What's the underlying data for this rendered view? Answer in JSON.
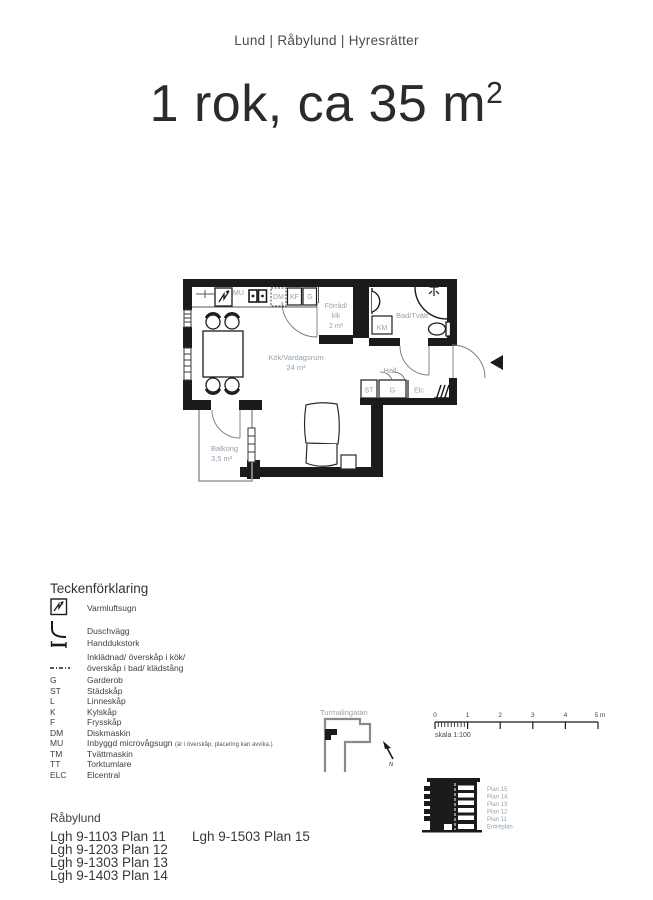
{
  "header": {
    "location_line": "Lund | Råbylund | Hyresrätter"
  },
  "title": {
    "main": "1 rok, ca 35 m",
    "sup": "2"
  },
  "floor_plan": {
    "rooms": {
      "kitchen_living": "Kök/Vardagsrum",
      "kitchen_living_area": "24 m²",
      "storage_line1": "Förråd/",
      "storage_line2": "klk",
      "storage_area": "2 m²",
      "bathroom": "Bad/Tvätt",
      "hall": "Hall",
      "balcony": "Balkong",
      "balcony_area": "3,5 m²"
    },
    "appliances": {
      "mu": "MU",
      "dm": "DM",
      "kf": "KF",
      "g_kitchen": "G",
      "km": "KM",
      "st": "ST",
      "g_hall": "G",
      "elc": "Elc"
    }
  },
  "legend": {
    "heading": "Teckenförklaring",
    "items": [
      {
        "abbr": "",
        "label": "Varmluftsugn"
      },
      {
        "abbr": "",
        "label": "Duschvägg"
      },
      {
        "abbr": "",
        "label": "Handdukstork"
      },
      {
        "abbr": "",
        "label": "Inklädnad/ överskåp i kök/"
      },
      {
        "abbr": "",
        "label": "överskåp i bad/ klädstång"
      },
      {
        "abbr": "G",
        "label": "Garderob"
      },
      {
        "abbr": "ST",
        "label": "Städskåp"
      },
      {
        "abbr": "L",
        "label": "Linneskåp"
      },
      {
        "abbr": "K",
        "label": "Kylskåp"
      },
      {
        "abbr": "F",
        "label": "Frysskåp"
      },
      {
        "abbr": "DM",
        "label": "Diskmaskin"
      },
      {
        "abbr": "MU",
        "label": "Inbyggd microvågsugn",
        "note": "(är i överskåp, placering kan avvika.)"
      },
      {
        "abbr": "TM",
        "label": "Tvättmaskin"
      },
      {
        "abbr": "TT",
        "label": "Torktumlare"
      },
      {
        "abbr": "ELC",
        "label": "Elcentral"
      }
    ]
  },
  "site_plan": {
    "street": "Turmalingatan",
    "north_label": "N"
  },
  "scale_bar": {
    "ticks": [
      "0",
      "1",
      "2",
      "3",
      "4",
      "5 m"
    ],
    "caption": "skala 1:100"
  },
  "elevation": {
    "floors": [
      "Plan 15",
      "Plan 14",
      "Plan 13",
      "Plan 12",
      "Plan 11",
      "Entréplan"
    ]
  },
  "footer": {
    "heading": "Råbylund",
    "column1": [
      "Lgh 9-1103 Plan 11",
      "Lgh 9-1203 Plan 12",
      "Lgh 9-1303 Plan 13",
      "Lgh 9-1403 Plan 14"
    ],
    "column2": [
      "Lgh 9-1503 Plan 15"
    ]
  },
  "colors": {
    "wall": "#1b1b1b",
    "room_label": "#94a2ae",
    "text_dark": "#2b2b2b",
    "outline_gray": "#8a8a8a"
  }
}
